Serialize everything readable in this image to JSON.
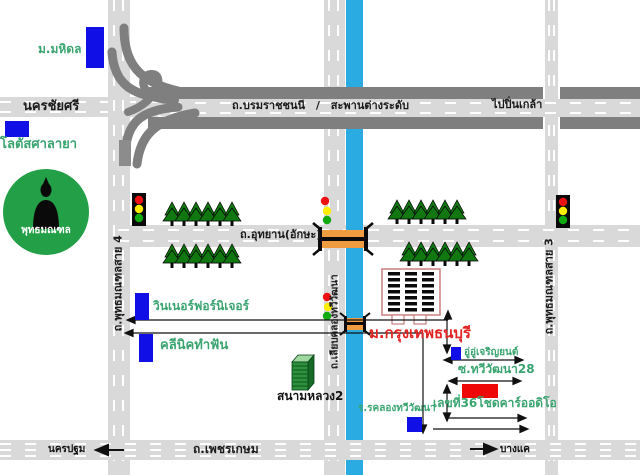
{
  "colors": {
    "road_gray": "#d9d9d9",
    "highway_gray": "#7f7f7f",
    "canal_blue": "#2aabe2",
    "marker_blue": "#0f0fe6",
    "marker_red": "#ee0808",
    "tree_green": "#117711",
    "circle_green": "#23a047",
    "label_green": "#3aa470",
    "university_red": "#e32222",
    "bridge_orange": "#ef9b3f"
  },
  "map": {
    "places": {
      "mahidol": "ม.มหิดล",
      "lotus": "โลตัสศาลายา",
      "phutthamonthon": "พุทธมณฑล",
      "winner_furniture": "วินเนอร์ฟอร์นิเจอร์",
      "dental_clinic": "คลีนิคทำฟัน",
      "sanam_luang_2": "สนามหลวง2",
      "bangkokthonburi_university": "ม.กรุงเทพธนบุรี",
      "garage": "อู่อู่เจริญยนต์",
      "car_audio": "เลขที่36โชดคาร์ออดิโอ",
      "school": "ร.รคลองทวีวัฒนา"
    },
    "roads": {
      "nakhon_chai_si": "นครชัยศรี",
      "borommaratchachonnani": "ถ.บรมราชชนนี",
      "separator": "/",
      "overpass": "สะพานต่างระดับ",
      "to_pin_klao": "ไปปิ่นเกล้า",
      "phutthamonthon_sai_4": "ถ.พุทธมณฑลสาย 4",
      "phutthamonthon_sai_3": "ถ.พุทธมณฑลสาย 3",
      "utthayan": "ถ.อุทยาน(อักษะ)",
      "liap_khlong_thawi_watthana": "ถ.เลียบคลองทวีวัฒนา",
      "soi_thawi_watthana_28": "ซ.ทวีวัฒนา28",
      "phetkasem": "ถ.เพชรเกษม"
    },
    "directions": {
      "nakhon_pathom": "นครปฐม",
      "bang_khae": "บางแค"
    },
    "tree_rows": [
      {
        "start": 172,
        "base": 226,
        "count": 6,
        "gap": 12
      },
      {
        "start": 172,
        "base": 268,
        "count": 6,
        "gap": 12
      },
      {
        "start": 397,
        "base": 224,
        "count": 6,
        "gap": 12
      },
      {
        "start": 409,
        "base": 266,
        "count": 6,
        "gap": 12
      }
    ],
    "university_windows": {
      "cols": [
        388,
        405,
        422
      ],
      "row_start": 272,
      "row_step": 6,
      "row_count": 7,
      "w": 12,
      "h": 3.5
    }
  }
}
